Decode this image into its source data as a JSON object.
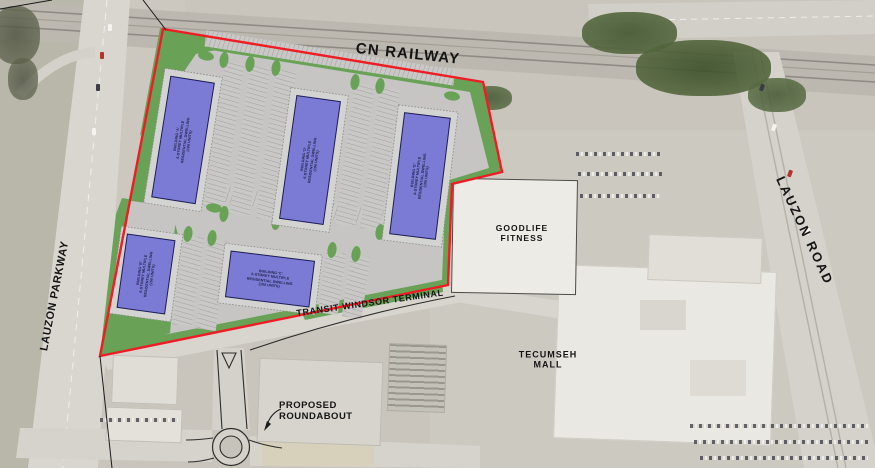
{
  "road_labels": {
    "cn_railway": "CN RAILWAY",
    "lauzon_parkway": "LAUZON PARKWAY",
    "lauzon_road": "LAUZON ROAD",
    "transit_windsor_terminal": "TRANSIT WINDSOR TERMINAL"
  },
  "place_labels": {
    "goodlife_line1": "GOODLIFE",
    "goodlife_line2": "FITNESS",
    "tecumseh_line1": "TECUMSEH",
    "tecumseh_line2": "MALL",
    "roundabout_line1": "PROPOSED",
    "roundabout_line2": "ROUNDABOUT"
  },
  "site": {
    "buildings": [
      {
        "lines": [
          "BUILDING 'A'",
          "6-STOREY MULTIPLE",
          "RESIDENTIAL DWELLING",
          "(190 UNITS)"
        ]
      },
      {
        "lines": [
          "BUILDING 'D'",
          "6-STOREY MULTIPLE",
          "RESIDENTIAL DWELLING",
          "(190 UNITS)"
        ]
      },
      {
        "lines": [
          "BUILDING 'E'",
          "6-STOREY MULTIPLE",
          "RESIDENTIAL DWELLING",
          "(190 UNITS)"
        ]
      },
      {
        "lines": [
          "BUILDING 'B'",
          "6-STOREY MULTIPLE",
          "RESIDENTIAL DWELLING",
          "(150 UNITS)"
        ]
      },
      {
        "lines": [
          "BUILDING 'C'",
          "6-STOREY MULTIPLE",
          "RESIDENTIAL DWELLING",
          "(150 UNITS)"
        ]
      }
    ]
  },
  "colors": {
    "site_boundary_red": "#ee1d25",
    "landscape_green": "#69a257",
    "building_blue": "#7b7bd6",
    "parking_gray": "#c6c5c3"
  }
}
